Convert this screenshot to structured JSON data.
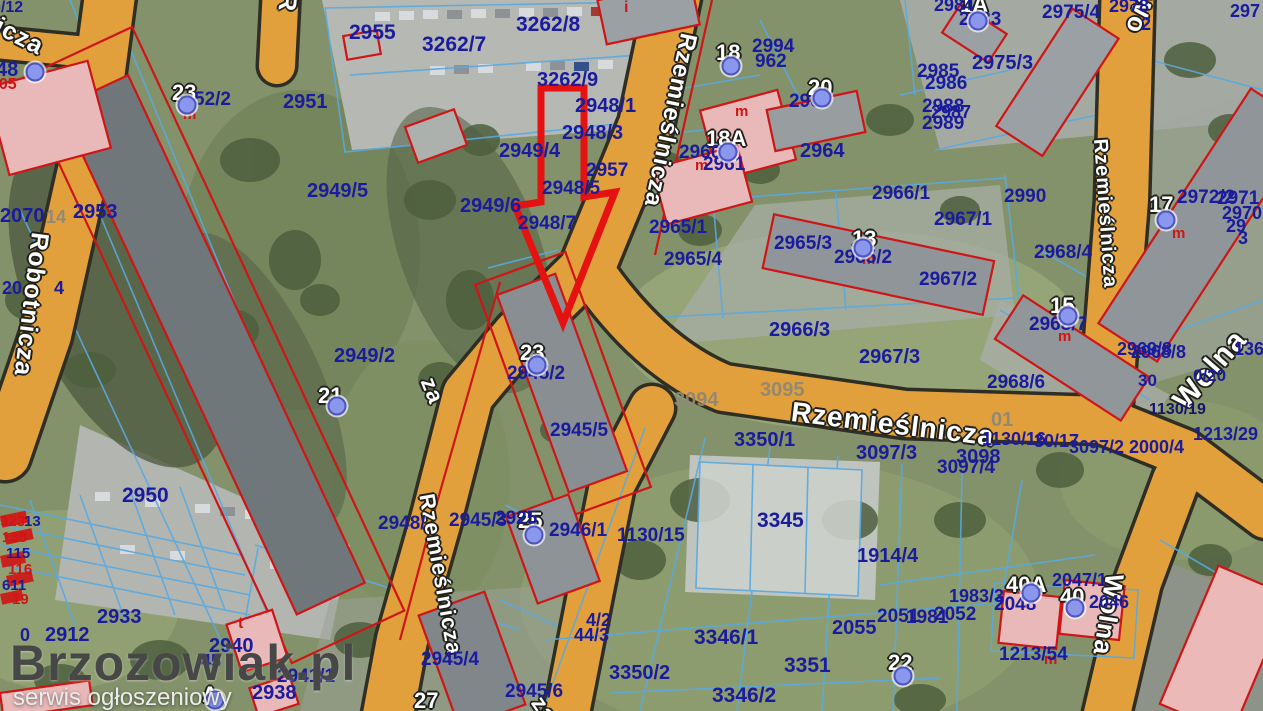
{
  "watermark": {
    "title": "Brzozowiak.pl",
    "subtitle": "serwis ogłoszeniowy"
  },
  "colors": {
    "road_fill": "#e2a03c",
    "road_border": "#2f2e24",
    "parcel_text": "#1b1b9e",
    "parcel_line": "#5aa9e0",
    "building_outline": "#cf1515",
    "highlight_arrow": "#e51212",
    "marker_dot": "#8a97ec",
    "grass": "#83926a"
  },
  "labels": [
    {
      "t": "icza",
      "x": 2,
      "y": 14,
      "k": "s",
      "s": 25,
      "r": 27
    },
    {
      "t": "R",
      "x": 300,
      "y": -6,
      "k": "s",
      "s": 25,
      "r": 95
    },
    {
      "t": "Robotnicza",
      "x": 52,
      "y": 234,
      "k": "s",
      "s": 25,
      "r": 97
    },
    {
      "t": "Rzemieślnicza",
      "x": 700,
      "y": 36,
      "k": "s",
      "s": 24,
      "r": 102
    },
    {
      "t": "za",
      "x": 438,
      "y": 374,
      "k": "s",
      "s": 23,
      "r": 68
    },
    {
      "t": "Rzemieślnicza",
      "x": 437,
      "y": 492,
      "k": "s",
      "s": 22,
      "r": 80
    },
    {
      "t": "za",
      "x": 546,
      "y": 692,
      "k": "s",
      "s": 23,
      "r": 55
    },
    {
      "t": "Rzemieślnicza",
      "x": 793,
      "y": 398,
      "k": "s",
      "s": 28,
      "r": 7
    },
    {
      "t": "Rzemieślnicza",
      "x": 1110,
      "y": 138,
      "k": "s",
      "s": 20,
      "r": 86
    },
    {
      "t": "Wo",
      "x": 1158,
      "y": -4,
      "k": "s",
      "s": 26,
      "r": 105
    },
    {
      "t": "Wolna",
      "x": 1168,
      "y": 396,
      "k": "s",
      "s": 30,
      "r": -49
    },
    {
      "t": "Wolna",
      "x": 1128,
      "y": 576,
      "k": "s",
      "s": 26,
      "r": 99
    },
    {
      "t": "23",
      "x": 172,
      "y": 82,
      "k": "b"
    },
    {
      "t": "18",
      "x": 716,
      "y": 42,
      "k": "b"
    },
    {
      "t": "18A",
      "x": 706,
      "y": 128,
      "k": "b"
    },
    {
      "t": "20",
      "x": 808,
      "y": 77,
      "k": "b"
    },
    {
      "t": "13",
      "x": 852,
      "y": 228,
      "k": "b"
    },
    {
      "t": "17",
      "x": 1149,
      "y": 194,
      "k": "b"
    },
    {
      "t": "15",
      "x": 1050,
      "y": 295,
      "k": "b"
    },
    {
      "t": "21",
      "x": 318,
      "y": 385,
      "k": "b"
    },
    {
      "t": "23",
      "x": 520,
      "y": 342,
      "k": "b"
    },
    {
      "t": "25",
      "x": 518,
      "y": 510,
      "k": "b"
    },
    {
      "t": "27",
      "x": 414,
      "y": 690,
      "k": "b"
    },
    {
      "t": "22",
      "x": 888,
      "y": 652,
      "k": "b"
    },
    {
      "t": "40A",
      "x": 1006,
      "y": 574,
      "k": "b"
    },
    {
      "t": "40",
      "x": 1060,
      "y": 586,
      "k": "b"
    },
    {
      "t": "1A",
      "x": 960,
      "y": -6,
      "k": "b"
    },
    {
      "t": "A",
      "x": 202,
      "y": 684,
      "k": "b"
    },
    {
      "t": "m",
      "x": 183,
      "y": 107,
      "k": "r"
    },
    {
      "t": "m",
      "x": 735,
      "y": 104,
      "k": "r"
    },
    {
      "t": "m",
      "x": 695,
      "y": 158,
      "k": "r"
    },
    {
      "t": "m",
      "x": 862,
      "y": 252,
      "k": "r"
    },
    {
      "t": "m",
      "x": 1172,
      "y": 226,
      "k": "r"
    },
    {
      "t": "m",
      "x": 1058,
      "y": 329,
      "k": "r"
    },
    {
      "t": "m",
      "x": 1044,
      "y": 652,
      "k": "r"
    },
    {
      "t": "i",
      "x": 624,
      "y": 0,
      "k": "r",
      "s": 16
    },
    {
      "t": "t",
      "x": 238,
      "y": 616,
      "k": "r",
      "s": 16
    },
    {
      "t": "305",
      "x": -10,
      "y": 77,
      "k": "r",
      "s": 16
    },
    {
      "t": "923",
      "x": 0,
      "y": 514,
      "k": "r"
    },
    {
      "t": "138",
      "x": 2,
      "y": 530,
      "k": "r"
    },
    {
      "t": "116",
      "x": 8,
      "y": 562,
      "k": "r"
    },
    {
      "t": "19",
      "x": 12,
      "y": 592,
      "k": "r"
    },
    {
      "t": "3094",
      "x": 674,
      "y": 390,
      "k": "g"
    },
    {
      "t": "3095",
      "x": 760,
      "y": 380,
      "k": "g"
    },
    {
      "t": "01",
      "x": 991,
      "y": 410,
      "k": "g"
    },
    {
      "t": "14",
      "x": 46,
      "y": 208,
      "k": "g",
      "s": 18
    },
    {
      "t": "0/12",
      "x": -8,
      "y": 0,
      "k": "p",
      "s": 16
    },
    {
      "t": "52/2",
      "x": 194,
      "y": 90,
      "k": "p",
      "s": 19
    },
    {
      "t": "2951",
      "x": 283,
      "y": 92,
      "k": "p",
      "s": 20
    },
    {
      "t": "2955",
      "x": 349,
      "y": 22,
      "k": "p",
      "s": 21
    },
    {
      "t": "3262/7",
      "x": 422,
      "y": 34,
      "k": "p",
      "s": 21
    },
    {
      "t": "3262/8",
      "x": 516,
      "y": 14,
      "k": "p",
      "s": 21
    },
    {
      "t": "3262/9",
      "x": 537,
      "y": 70,
      "k": "p",
      "s": 20
    },
    {
      "t": "2948/1",
      "x": 575,
      "y": 96,
      "k": "p",
      "s": 20
    },
    {
      "t": "2948/3",
      "x": 562,
      "y": 123,
      "k": "p",
      "s": 20
    },
    {
      "t": "2949/4",
      "x": 499,
      "y": 141,
      "k": "p",
      "s": 20
    },
    {
      "t": "2957",
      "x": 586,
      "y": 161,
      "k": "p",
      "s": 19
    },
    {
      "t": "2948/5",
      "x": 542,
      "y": 179,
      "k": "p",
      "s": 19
    },
    {
      "t": "2948/7",
      "x": 518,
      "y": 214,
      "k": "p",
      "s": 19
    },
    {
      "t": "2949/6",
      "x": 460,
      "y": 196,
      "k": "p",
      "s": 20
    },
    {
      "t": "2949/5",
      "x": 307,
      "y": 181,
      "k": "p",
      "s": 20
    },
    {
      "t": "2070",
      "x": 0,
      "y": 206,
      "k": "p",
      "s": 20
    },
    {
      "t": "2953",
      "x": 73,
      "y": 202,
      "k": "p",
      "s": 20
    },
    {
      "t": "20",
      "x": 2,
      "y": 279,
      "k": "p"
    },
    {
      "t": "4",
      "x": 54,
      "y": 279,
      "k": "p"
    },
    {
      "t": "2949/2",
      "x": 334,
      "y": 346,
      "k": "p",
      "s": 20
    },
    {
      "t": "2945/2",
      "x": 507,
      "y": 364,
      "k": "p",
      "s": 19
    },
    {
      "t": "2945/5",
      "x": 550,
      "y": 421,
      "k": "p",
      "s": 19
    },
    {
      "t": "2948/",
      "x": 378,
      "y": 514,
      "k": "p",
      "s": 19
    },
    {
      "t": "2945/3",
      "x": 449,
      "y": 511,
      "k": "p",
      "s": 19
    },
    {
      "t": "2925",
      "x": 495,
      "y": 509,
      "k": "p",
      "s": 19
    },
    {
      "t": "2946/1",
      "x": 549,
      "y": 521,
      "k": "p",
      "s": 19
    },
    {
      "t": "1130/15",
      "x": 617,
      "y": 526,
      "k": "p",
      "s": 19
    },
    {
      "t": "2965/1",
      "x": 649,
      "y": 218,
      "k": "p",
      "s": 19
    },
    {
      "t": "2965/4",
      "x": 664,
      "y": 250,
      "k": "p",
      "s": 19
    },
    {
      "t": "2965/3",
      "x": 774,
      "y": 234,
      "k": "p",
      "s": 19
    },
    {
      "t": "2965/2",
      "x": 834,
      "y": 248,
      "k": "p",
      "s": 19
    },
    {
      "t": "2966/1",
      "x": 872,
      "y": 184,
      "k": "p",
      "s": 19
    },
    {
      "t": "2967/1",
      "x": 934,
      "y": 210,
      "k": "p",
      "s": 19
    },
    {
      "t": "2967/2",
      "x": 919,
      "y": 270,
      "k": "p",
      "s": 19
    },
    {
      "t": "2968/4",
      "x": 1034,
      "y": 243,
      "k": "p",
      "s": 19
    },
    {
      "t": "2990",
      "x": 1004,
      "y": 187,
      "k": "p",
      "s": 19
    },
    {
      "t": "2972/2",
      "x": 1177,
      "y": 188,
      "k": "p",
      "s": 19
    },
    {
      "t": "2971",
      "x": 1217,
      "y": 189,
      "k": "p",
      "s": 19
    },
    {
      "t": "2970",
      "x": 1222,
      "y": 204,
      "k": "p"
    },
    {
      "t": "29",
      "x": 1226,
      "y": 217,
      "k": "p"
    },
    {
      "t": "3",
      "x": 1238,
      "y": 229,
      "k": "p"
    },
    {
      "t": "2969/8",
      "x": 1117,
      "y": 340,
      "k": "p"
    },
    {
      "t": "2968/8",
      "x": 1131,
      "y": 343,
      "k": "p"
    },
    {
      "t": "136",
      "x": 1234,
      "y": 340,
      "k": "p"
    },
    {
      "t": "30",
      "x": 1138,
      "y": 372,
      "k": "p",
      "s": 17
    },
    {
      "t": "0/20",
      "x": 1193,
      "y": 367,
      "k": "p",
      "s": 17
    },
    {
      "t": "1130/16",
      "x": 982,
      "y": 430,
      "k": "p"
    },
    {
      "t": "30/17",
      "x": 1034,
      "y": 432,
      "k": "p"
    },
    {
      "t": "3097/2",
      "x": 1069,
      "y": 438,
      "k": "p"
    },
    {
      "t": "2000/4",
      "x": 1129,
      "y": 438,
      "k": "p"
    },
    {
      "t": "1213/29",
      "x": 1193,
      "y": 425,
      "k": "p"
    },
    {
      "t": "1130/19",
      "x": 1149,
      "y": 402,
      "k": "d"
    },
    {
      "t": "2966/3",
      "x": 769,
      "y": 320,
      "k": "p",
      "s": 20
    },
    {
      "t": "2967/3",
      "x": 859,
      "y": 347,
      "k": "p",
      "s": 20
    },
    {
      "t": "2968/6",
      "x": 987,
      "y": 373,
      "k": "p",
      "s": 19
    },
    {
      "t": "2968/7",
      "x": 1029,
      "y": 315,
      "k": "p",
      "s": 19
    },
    {
      "t": "3350/1",
      "x": 734,
      "y": 430,
      "k": "p",
      "s": 20
    },
    {
      "t": "3097/3",
      "x": 856,
      "y": 443,
      "k": "p",
      "s": 20
    },
    {
      "t": "3098",
      "x": 956,
      "y": 447,
      "k": "p",
      "s": 20
    },
    {
      "t": "3097/4",
      "x": 937,
      "y": 458,
      "k": "p",
      "s": 19
    },
    {
      "t": "3345",
      "x": 757,
      "y": 510,
      "k": "p",
      "s": 21
    },
    {
      "t": "1914/4",
      "x": 857,
      "y": 546,
      "k": "p",
      "s": 20
    },
    {
      "t": "3346/1",
      "x": 694,
      "y": 627,
      "k": "p",
      "s": 21
    },
    {
      "t": "3350/2",
      "x": 609,
      "y": 663,
      "k": "p",
      "s": 20
    },
    {
      "t": "3351",
      "x": 784,
      "y": 655,
      "k": "p",
      "s": 21
    },
    {
      "t": "3346/2",
      "x": 712,
      "y": 685,
      "k": "p",
      "s": 21
    },
    {
      "t": "2055",
      "x": 832,
      "y": 618,
      "k": "p",
      "s": 20
    },
    {
      "t": "2051",
      "x": 877,
      "y": 607,
      "k": "p",
      "s": 19
    },
    {
      "t": "1981",
      "x": 906,
      "y": 608,
      "k": "p",
      "s": 19
    },
    {
      "t": "2052",
      "x": 934,
      "y": 605,
      "k": "p",
      "s": 19
    },
    {
      "t": "1983/3",
      "x": 949,
      "y": 587,
      "k": "p"
    },
    {
      "t": "2048",
      "x": 994,
      "y": 595,
      "k": "p",
      "s": 19
    },
    {
      "t": "2047/1",
      "x": 1052,
      "y": 571,
      "k": "p"
    },
    {
      "t": "2046",
      "x": 1089,
      "y": 593,
      "k": "p"
    },
    {
      "t": "1213/54",
      "x": 999,
      "y": 645,
      "k": "p",
      "s": 19
    },
    {
      "t": "4/2",
      "x": 586,
      "y": 611,
      "k": "p"
    },
    {
      "t": "44/3",
      "x": 574,
      "y": 626,
      "k": "p"
    },
    {
      "t": "2945/4",
      "x": 421,
      "y": 650,
      "k": "p",
      "s": 19
    },
    {
      "t": "2945/6",
      "x": 505,
      "y": 682,
      "k": "p",
      "s": 19
    },
    {
      "t": "2940",
      "x": 209,
      "y": 636,
      "k": "p",
      "s": 20
    },
    {
      "t": "2941/1",
      "x": 277,
      "y": 667,
      "k": "p",
      "s": 19
    },
    {
      "t": "2938",
      "x": 252,
      "y": 683,
      "k": "p",
      "s": 20
    },
    {
      "t": "2912",
      "x": 45,
      "y": 625,
      "k": "p",
      "s": 20
    },
    {
      "t": "0",
      "x": 20,
      "y": 626,
      "k": "p"
    },
    {
      "t": "2933",
      "x": 97,
      "y": 607,
      "k": "p",
      "s": 20
    },
    {
      "t": "2950",
      "x": 122,
      "y": 485,
      "k": "p",
      "s": 21
    },
    {
      "t": "45",
      "x": 201,
      "y": 652,
      "k": "p"
    },
    {
      "t": "48",
      "x": -4,
      "y": 60,
      "k": "p",
      "s": 20
    },
    {
      "t": "13",
      "x": 24,
      "y": 514,
      "k": "p",
      "s": 15
    },
    {
      "t": "115",
      "x": 6,
      "y": 546,
      "k": "p",
      "s": 15
    },
    {
      "t": "611",
      "x": 2,
      "y": 578,
      "k": "p",
      "s": 15
    },
    {
      "t": "2994",
      "x": 752,
      "y": 37,
      "k": "p",
      "s": 19
    },
    {
      "t": "962",
      "x": 755,
      "y": 52,
      "k": "p",
      "s": 19
    },
    {
      "t": "2960",
      "x": 679,
      "y": 143,
      "k": "p",
      "s": 19
    },
    {
      "t": "2961",
      "x": 703,
      "y": 155,
      "k": "p",
      "s": 19
    },
    {
      "t": "2963",
      "x": 789,
      "y": 92,
      "k": "p",
      "s": 19
    },
    {
      "t": "2964",
      "x": 800,
      "y": 141,
      "k": "p",
      "s": 20
    },
    {
      "t": "2985",
      "x": 917,
      "y": 62,
      "k": "p",
      "s": 19
    },
    {
      "t": "2986",
      "x": 925,
      "y": 74,
      "k": "p",
      "s": 19
    },
    {
      "t": "2988",
      "x": 922,
      "y": 97,
      "k": "p",
      "s": 19
    },
    {
      "t": "2987",
      "x": 931,
      "y": 103,
      "k": "p"
    },
    {
      "t": "2989",
      "x": 922,
      "y": 114,
      "k": "p",
      "s": 19
    },
    {
      "t": "2984",
      "x": 934,
      "y": -4,
      "k": "p"
    },
    {
      "t": "2983",
      "x": 959,
      "y": 10,
      "k": "p",
      "s": 19
    },
    {
      "t": "2975/3",
      "x": 972,
      "y": 53,
      "k": "p",
      "s": 20
    },
    {
      "t": "2975/4",
      "x": 1042,
      "y": 3,
      "k": "p",
      "s": 19
    },
    {
      "t": "2978",
      "x": 1109,
      "y": -3,
      "k": "p"
    },
    {
      "t": "2",
      "x": 1141,
      "y": 15,
      "k": "p"
    },
    {
      "t": "297",
      "x": 1230,
      "y": 2,
      "k": "p"
    }
  ],
  "dots": [
    [
      35,
      72
    ],
    [
      187,
      105
    ],
    [
      337,
      406
    ],
    [
      537,
      365
    ],
    [
      534,
      535
    ],
    [
      731,
      66
    ],
    [
      728,
      152
    ],
    [
      822,
      98
    ],
    [
      863,
      248
    ],
    [
      978,
      21
    ],
    [
      1166,
      220
    ],
    [
      1068,
      316
    ],
    [
      903,
      676
    ],
    [
      1031,
      593
    ],
    [
      1075,
      608
    ],
    [
      215,
      700
    ]
  ]
}
